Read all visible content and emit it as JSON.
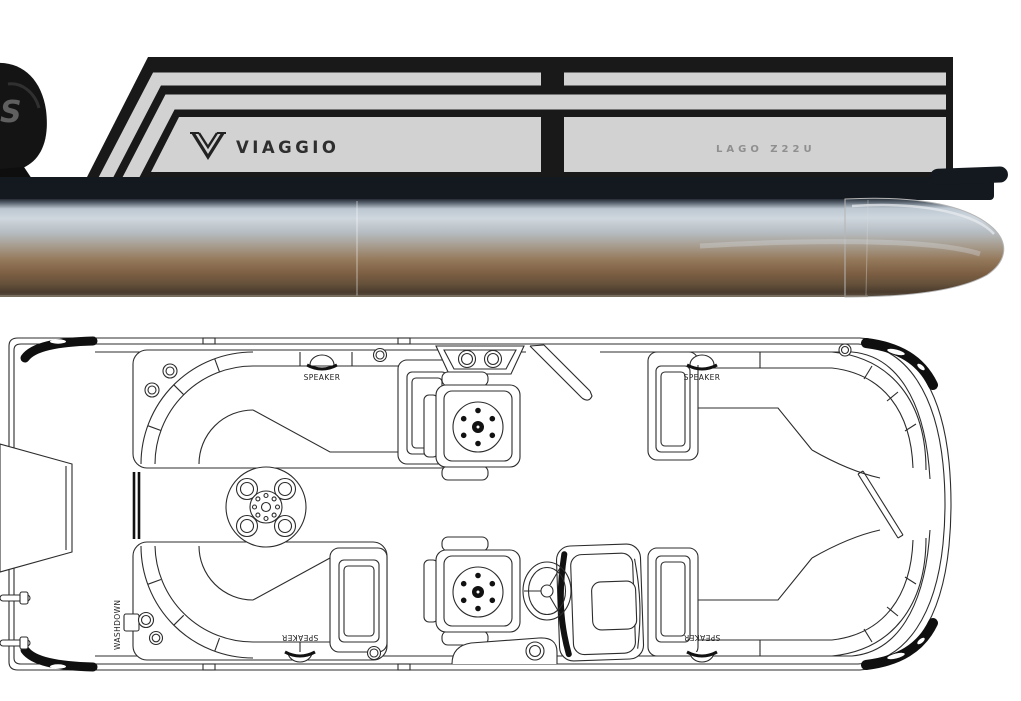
{
  "side_view": {
    "brand": "VIAGGIO",
    "model": "LAGO Z22U",
    "motor_badge": "S",
    "colors": {
      "panel_gray": "#d2d2d2",
      "trim_black": "#191919",
      "tube_sky_reflection": "#cfd7de",
      "tube_earth_reflection": "#95795b"
    }
  },
  "floor_plan": {
    "labels": {
      "speaker": "SPEAKER",
      "washdown": "WASHDOWN"
    },
    "line_color": "#2c2c2c"
  }
}
